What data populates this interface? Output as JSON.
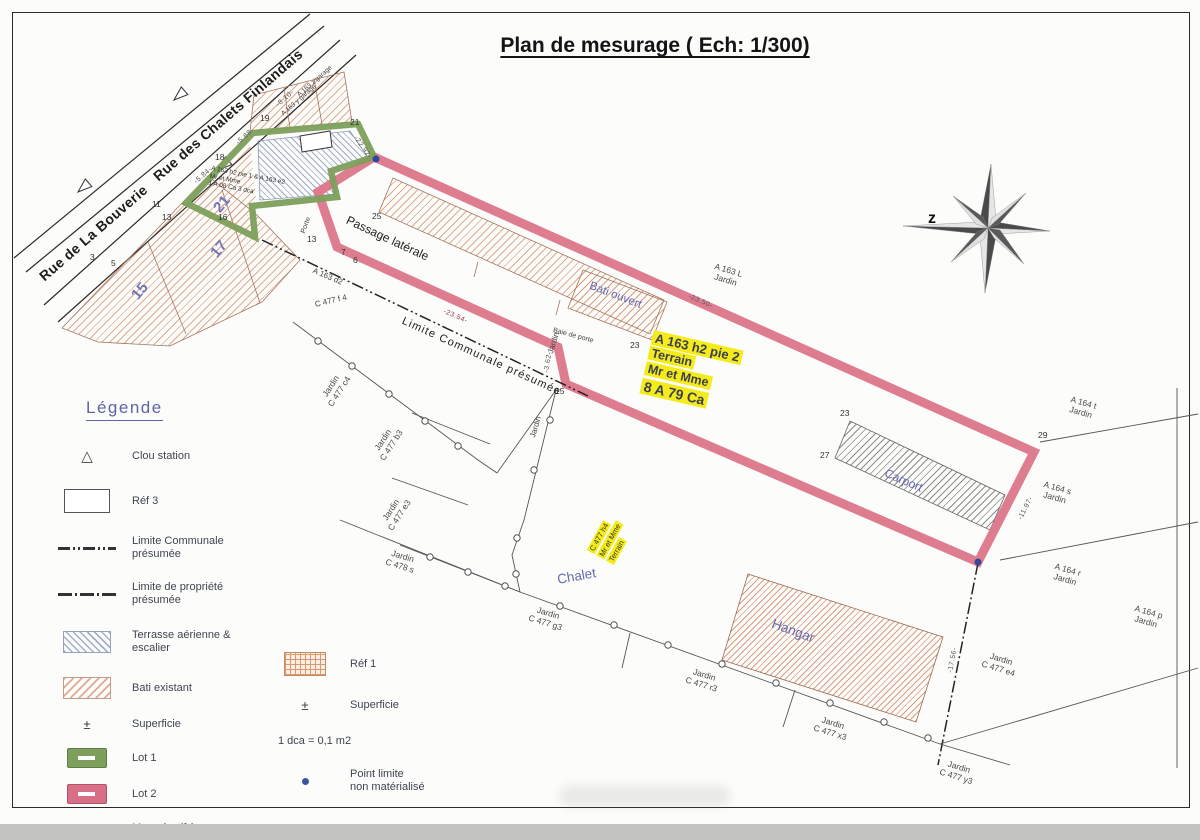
{
  "title": "Plan de mesurage ( Ech: 1/300)",
  "compass_label": "z",
  "streets": {
    "bouverie": "Rue de La Bouverie",
    "chalets": "Rue des Chalets Finlandais"
  },
  "parcel_numbers": {
    "p15": "15",
    "p17": "17",
    "p21": "21"
  },
  "points": {
    "p3": "3",
    "p5": "5",
    "p11": "11",
    "p13": "13",
    "p16": "16",
    "p18": "18",
    "p19": "19",
    "p21": "21",
    "p13b": "13",
    "p25": "25",
    "p7": "7",
    "p6": "6",
    "p23": "23",
    "p15b": "15",
    "p23b": "23",
    "p27": "27",
    "p29": "29"
  },
  "dimensions": {
    "d810": "-8.10-",
    "d568": "-5.68-",
    "d584": "-5.84-",
    "d2292": "-22.92-",
    "d2354": "-23.54-",
    "d2350": "-23.50-",
    "d362": "-3.62-",
    "d1197": "-11.97-",
    "d1756": "-17.56-"
  },
  "buildings": {
    "bati_ouvert": "Bati ouvert",
    "carport": "Carport",
    "chalet": "Chalet",
    "hangar": "Hangar",
    "garage_z": "A 163 z garage",
    "garage_y": "A 163 y garage"
  },
  "annotations": {
    "passage": "Passage latérale",
    "limite_communale": "Limite Communale présumée",
    "a163d2": "A 163 d2",
    "c477f4": "C 477 f 4",
    "porte": "Porte",
    "baie_de_porte": "Baie de porte",
    "jardin": "Jardin",
    "lot1_block": {
      "l1": "A 163 h2 pie 1 & A 163 e2",
      "l2": "Mr et Mme",
      "l3": "1 A 08 Ca 3 dca"
    }
  },
  "highlights": {
    "terrain": {
      "l1": "A 163 h2 pie 2",
      "l2": "Terrain",
      "l3": "Mr et  Mme",
      "l4": "8 A 79 Ca"
    },
    "c477h4": {
      "l1": "C 477 h4",
      "l2": "Mr et Mme",
      "l3": "Terrain"
    }
  },
  "jardins": {
    "a163l": {
      "l1": "A 163 L",
      "l2": "Jardin"
    },
    "a164t": {
      "l1": "A 164 t",
      "l2": "Jardin"
    },
    "a164s": {
      "l1": "A 164 s",
      "l2": "Jardin"
    },
    "a164r": {
      "l1": "A 164 r",
      "l2": "Jardin"
    },
    "a164p": {
      "l1": "A 164 p",
      "l2": "Jardin"
    },
    "c477c4": {
      "l1": "Jardin",
      "l2": "C 477 c4"
    },
    "c477b3": {
      "l1": "Jardin",
      "l2": "C 477 b3"
    },
    "c477e3": {
      "l1": "Jardin",
      "l2": "C 477 e3"
    },
    "c478s": {
      "l1": "Jardin",
      "l2": "C 478 s"
    },
    "c477g3": {
      "l1": "Jardin",
      "l2": "C 477 g3"
    },
    "c477r3": {
      "l1": "Jardin",
      "l2": "C 477 r3"
    },
    "c477x3": {
      "l1": "Jardin",
      "l2": "C 477 x3"
    },
    "c477y3": {
      "l1": "Jardin",
      "l2": "C 477 y3"
    },
    "c477e4": {
      "l1": "Jardin",
      "l2": "C 477 e4"
    }
  },
  "legend": {
    "heading": "Légende",
    "clou": "Clou station",
    "ref3": "Réf 3",
    "lim_com_1": "Limite Communale",
    "lim_com_2": "présumée",
    "lim_prop_1": "Limite de propriété",
    "lim_prop_2": "présumée",
    "terrasse_1": "Terrasse aérienne &",
    "terrasse_2": "escalier",
    "bati": "Bati existant",
    "superficie_sym": "±",
    "superficie": "Superficie",
    "lot1": "Lot 1",
    "lot2": "Lot 2",
    "mur_1": "Mur privatif à",
    "mur_2": "la parcelle A 163 d2",
    "ref1": "Réf 1",
    "superficie2_sym": "±",
    "superficie2": "Superficie",
    "dca": "1 dca = 0,1 m2",
    "point_limite_1": "Point limite",
    "point_limite_2": "non matérialisé"
  },
  "colors": {
    "lot1_green": "#7d9f5b",
    "lot2_pink": "#dc7287",
    "highlight_yellow": "#f4ec1a",
    "label_blue": "#666aad"
  }
}
